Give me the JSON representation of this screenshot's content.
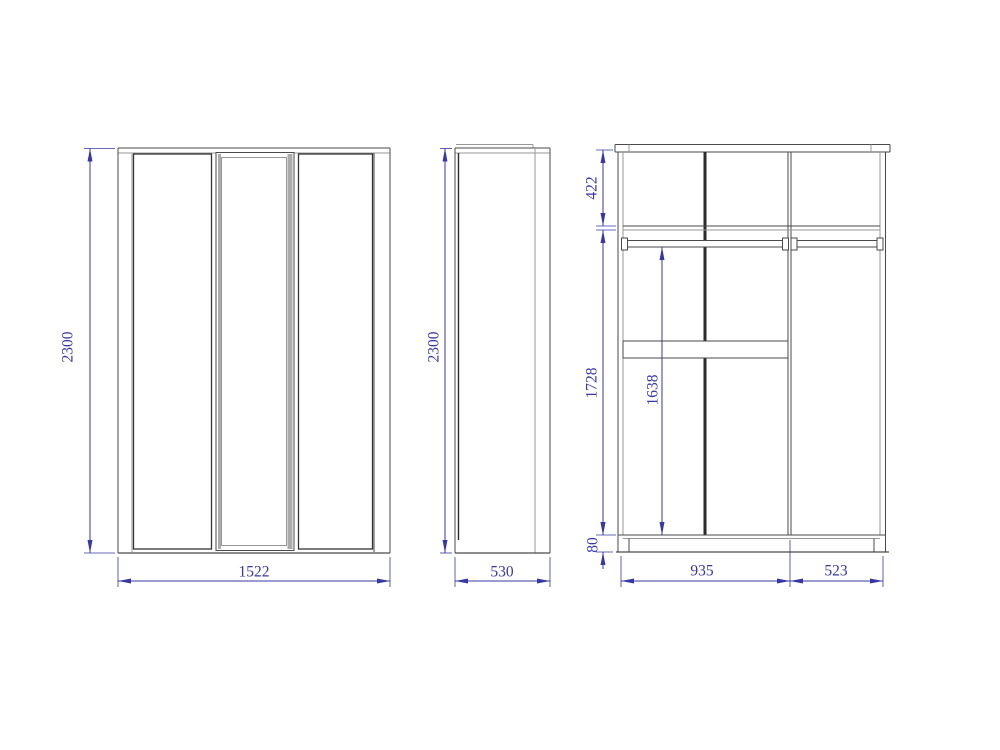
{
  "drawing": {
    "subject": "three-door wardrobe orthographic technical drawing",
    "colors": {
      "background": "#ffffff",
      "outline": "#4a4a4a",
      "outline_dark": "#2b2b2b",
      "outline_light": "#979797",
      "mirror_shade": "#ababab",
      "dimension": "#3737a6"
    },
    "views": {
      "front": {
        "dimensions": {
          "height": "2300",
          "width": "1522"
        }
      },
      "side": {
        "dimensions": {
          "height": "2300",
          "depth": "530"
        }
      },
      "internal": {
        "dimensions": {
          "top_section_height": "422",
          "lower_section_height": "1728",
          "hanging_height": "1638",
          "plinth_height": "80",
          "left_section_width": "935",
          "right_section_width": "523"
        }
      }
    }
  }
}
